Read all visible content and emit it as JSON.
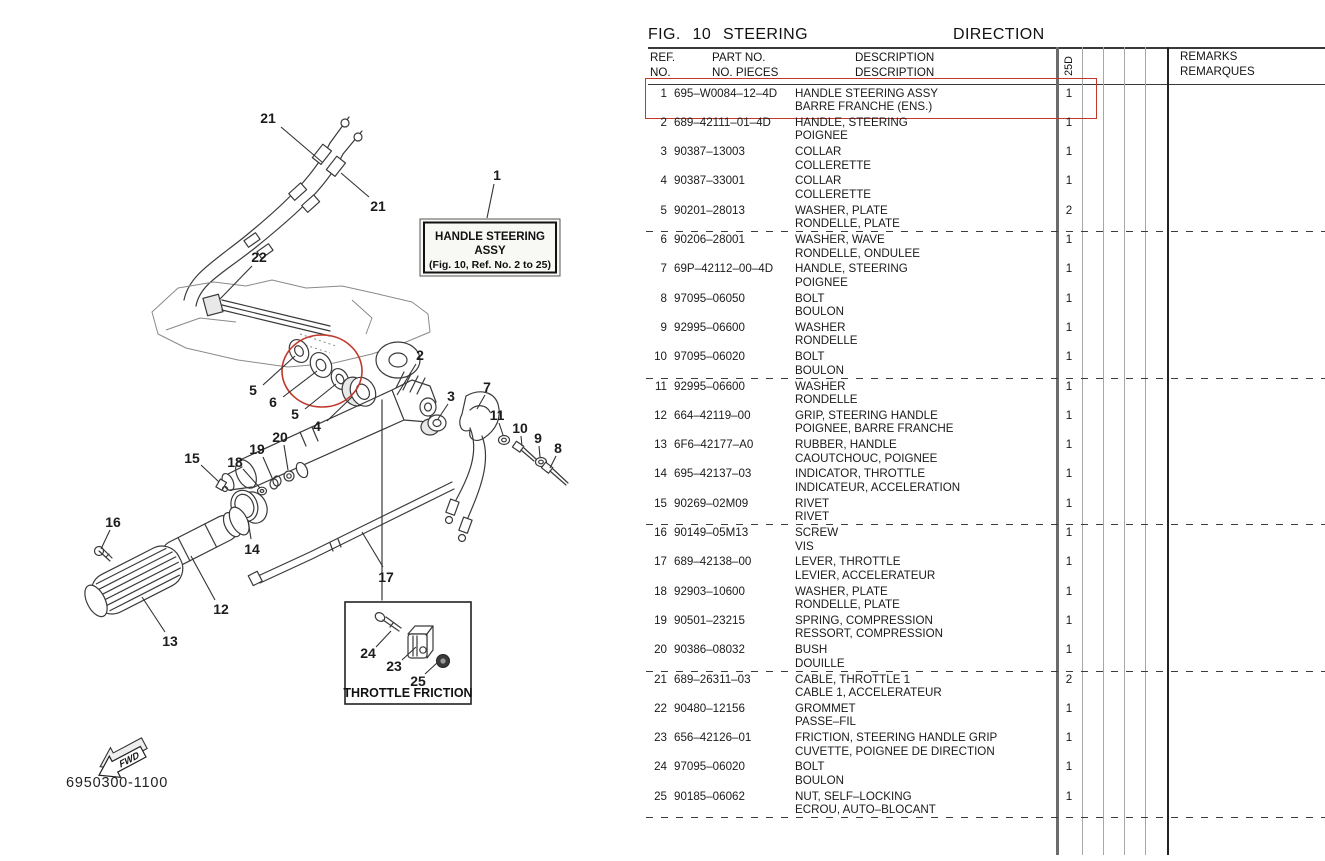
{
  "page": {
    "fig_title": "FIG.  10   STEERING",
    "fig_title_fr": "DIRECTION",
    "doc_number": "6950300-1100"
  },
  "colors": {
    "highlight_red": "#c0392b",
    "line_black": "#3a3a3a"
  },
  "table": {
    "headers": {
      "ref_1": "REF.",
      "ref_2": "NO.",
      "part_1": "PART NO.",
      "part_2": "NO. PIECES",
      "desc_1": "DESCRIPTION",
      "desc_2": "DESCRIPTION",
      "model_col": "25D",
      "remarks_1": "REMARKS",
      "remarks_2": "REMARQUES"
    },
    "group_separator_after_rows": [
      5,
      10,
      15,
      20,
      25
    ],
    "highlighted_ref": "1",
    "rows": [
      {
        "ref": "1",
        "part": "695–W0084–12–4D",
        "desc_en": "HANDLE STEERING ASSY",
        "desc_fr": "BARRE FRANCHE (ENS.)",
        "qty": "1",
        "highlight": true
      },
      {
        "ref": "2",
        "part": "689–42111–01–4D",
        "desc_en": "HANDLE, STEERING",
        "desc_fr": "POIGNEE",
        "qty": "1",
        "highlight": false
      },
      {
        "ref": "3",
        "part": "90387–13003",
        "desc_en": "COLLAR",
        "desc_fr": "COLLERETTE",
        "qty": "1",
        "highlight": false
      },
      {
        "ref": "4",
        "part": "90387–33001",
        "desc_en": "COLLAR",
        "desc_fr": "COLLERETTE",
        "qty": "1",
        "highlight": false
      },
      {
        "ref": "5",
        "part": "90201–28013",
        "desc_en": "WASHER, PLATE",
        "desc_fr": "RONDELLE, PLATE",
        "qty": "2",
        "highlight": false
      },
      {
        "ref": "6",
        "part": "90206–28001",
        "desc_en": "WASHER, WAVE",
        "desc_fr": "RONDELLE, ONDULEE",
        "qty": "1",
        "highlight": false
      },
      {
        "ref": "7",
        "part": "69P–42112–00–4D",
        "desc_en": "HANDLE, STEERING",
        "desc_fr": "POIGNEE",
        "qty": "1",
        "highlight": false
      },
      {
        "ref": "8",
        "part": "97095–06050",
        "desc_en": "BOLT",
        "desc_fr": "BOULON",
        "qty": "1",
        "highlight": false
      },
      {
        "ref": "9",
        "part": "92995–06600",
        "desc_en": "WASHER",
        "desc_fr": "RONDELLE",
        "qty": "1",
        "highlight": false
      },
      {
        "ref": "10",
        "part": "97095–06020",
        "des_en": "",
        "desc_en": "BOLT",
        "desc_fr": "BOULON",
        "qty": "1",
        "highlight": false
      },
      {
        "ref": "11",
        "part": "92995–06600",
        "desc_en": "WASHER",
        "desc_fr": "RONDELLE",
        "qty": "1",
        "highlight": false
      },
      {
        "ref": "12",
        "part": "664–42119–00",
        "desc_en": "GRIP, STEERING HANDLE",
        "desc_fr": "POIGNEE, BARRE FRANCHE",
        "qty": "1",
        "highlight": false
      },
      {
        "ref": "13",
        "part": "6F6–42177–A0",
        "desc_en": "RUBBER, HANDLE",
        "desc_fr": "CAOUTCHOUC, POIGNEE",
        "qty": "1",
        "highlight": false
      },
      {
        "ref": "14",
        "part": "695–42137–03",
        "desc_en": "INDICATOR, THROTTLE",
        "desc_fr": "INDICATEUR, ACCELERATION",
        "qty": "1",
        "highlight": false
      },
      {
        "ref": "15",
        "part": "90269–02M09",
        "desc_en": "RIVET",
        "desc_fr": "RIVET",
        "qty": "1",
        "highlight": false
      },
      {
        "ref": "16",
        "part": "90149–05M13",
        "desc_en": "SCREW",
        "desc_fr": "VIS",
        "qty": "1",
        "highlight": false
      },
      {
        "ref": "17",
        "part": "689–42138–00",
        "desc_en": "LEVER, THROTTLE",
        "desc_fr": "LEVIER, ACCELERATEUR",
        "qty": "1",
        "highlight": false
      },
      {
        "ref": "18",
        "part": "92903–10600",
        "desc_en": "WASHER, PLATE",
        "desc_fr": "RONDELLE, PLATE",
        "qty": "1",
        "highlight": false
      },
      {
        "ref": "19",
        "part": "90501–23215",
        "desc_en": "SPRING, COMPRESSION",
        "desc_fr": "RESSORT, COMPRESSION",
        "qty": "1",
        "highlight": false
      },
      {
        "ref": "20",
        "part": "90386–08032",
        "desc_en": "BUSH",
        "desc_fr": "DOUILLE",
        "qty": "1",
        "highlight": false
      },
      {
        "ref": "21",
        "part": "689–26311–03",
        "desc_en": "CABLE, THROTTLE 1",
        "desc_fr": "CABLE 1, ACCELERATEUR",
        "qty": "2",
        "highlight": false
      },
      {
        "ref": "22",
        "part": "90480–12156",
        "desc_en": "GROMMET",
        "desc_fr": "PASSE–FIL",
        "qty": "1",
        "highlight": false
      },
      {
        "ref": "23",
        "part": "656–42126–01",
        "desc_en": "FRICTION, STEERING HANDLE GRIP",
        "desc_fr": "CUVETTE, POIGNEE DE DIRECTION",
        "qty": "1",
        "highlight": false
      },
      {
        "ref": "24",
        "part": "97095–06020",
        "desc_en": "BOLT",
        "desc_fr": "BOULON",
        "qty": "1",
        "highlight": false
      },
      {
        "ref": "25",
        "part": "90185–06062",
        "desc_en": "NUT, SELF–LOCKING",
        "desc_fr": "ECROU, AUTO–BLOCANT",
        "qty": "1",
        "highlight": false
      }
    ]
  },
  "diagram": {
    "callout_box": {
      "line1": "HANDLE STEERING",
      "line2": "ASSY",
      "line3": "(Fig. 10, Ref. No. 2 to 25)"
    },
    "throttle_friction_label": "THROTTLE FRICTION",
    "fwd_label": "FWD",
    "labels": [
      {
        "t": "21",
        "x": 268,
        "y": 118,
        "lx1": 281,
        "ly1": 127,
        "lx2": 322,
        "ly2": 162
      },
      {
        "t": "21",
        "x": 378,
        "y": 206,
        "lx1": 369,
        "ly1": 197,
        "lx2": 341,
        "ly2": 173
      },
      {
        "t": "22",
        "x": 259,
        "y": 257,
        "lx1": 252,
        "ly1": 266,
        "lx2": 220,
        "ly2": 299
      },
      {
        "t": "1",
        "x": 497,
        "y": 175,
        "lx1": 494,
        "ly1": 184,
        "lx2": 487,
        "ly2": 218
      },
      {
        "t": "5",
        "x": 253,
        "y": 390,
        "lx1": 263,
        "ly1": 385,
        "lx2": 295,
        "ly2": 356
      },
      {
        "t": "6",
        "x": 273,
        "y": 402,
        "lx1": 283,
        "ly1": 397,
        "lx2": 317,
        "ly2": 371
      },
      {
        "t": "5",
        "x": 295,
        "y": 414,
        "lx1": 305,
        "ly1": 409,
        "lx2": 336,
        "ly2": 384
      },
      {
        "t": "4",
        "x": 317,
        "y": 426,
        "lx1": 327,
        "ly1": 421,
        "lx2": 352,
        "ly2": 397
      },
      {
        "t": "2",
        "x": 420,
        "y": 355,
        "lx1": 416,
        "ly1": 364,
        "lx2": 397,
        "ly2": 395
      },
      {
        "t": "3",
        "x": 451,
        "y": 396,
        "lx1": 448,
        "ly1": 404,
        "lx2": 438,
        "ly2": 419
      },
      {
        "t": "7",
        "x": 487,
        "y": 387,
        "lx1": 485,
        "ly1": 395,
        "lx2": 477,
        "ly2": 409
      },
      {
        "t": "11",
        "x": 497,
        "y": 415,
        "lx1": 499,
        "ly1": 423,
        "lx2": 503,
        "ly2": 435
      },
      {
        "t": "10",
        "x": 520,
        "y": 428,
        "lx1": 521,
        "ly1": 436,
        "lx2": 522,
        "ly2": 446
      },
      {
        "t": "9",
        "x": 538,
        "y": 438,
        "lx1": 539,
        "ly1": 446,
        "lx2": 540,
        "ly2": 457
      },
      {
        "t": "8",
        "x": 558,
        "y": 448,
        "lx1": 556,
        "ly1": 456,
        "lx2": 550,
        "ly2": 468
      },
      {
        "t": "15",
        "x": 192,
        "y": 458,
        "lx1": 201,
        "ly1": 465,
        "lx2": 219,
        "ly2": 482
      },
      {
        "t": "18",
        "x": 235,
        "y": 462,
        "lx1": 243,
        "ly1": 469,
        "lx2": 260,
        "ly2": 488
      },
      {
        "t": "19",
        "x": 257,
        "y": 449,
        "lx1": 263,
        "ly1": 457,
        "lx2": 273,
        "ly2": 480
      },
      {
        "t": "20",
        "x": 280,
        "y": 437,
        "lx1": 284,
        "ly1": 445,
        "lx2": 288,
        "ly2": 470
      },
      {
        "t": "16",
        "x": 113,
        "y": 522,
        "lx1": 110,
        "ly1": 530,
        "lx2": 101,
        "ly2": 549
      },
      {
        "t": "14",
        "x": 252,
        "y": 549,
        "lx1": 251,
        "ly1": 539,
        "lx2": 248,
        "ly2": 520
      },
      {
        "t": "12",
        "x": 221,
        "y": 609,
        "lx1": 215,
        "ly1": 600,
        "lx2": 191,
        "ly2": 556
      },
      {
        "t": "13",
        "x": 170,
        "y": 641,
        "lx1": 165,
        "ly1": 632,
        "lx2": 142,
        "ly2": 597
      },
      {
        "t": "17",
        "x": 386,
        "y": 577,
        "lx1": 383,
        "ly1": 567,
        "lx2": 362,
        "ly2": 532
      },
      {
        "t": "24",
        "x": 368,
        "y": 653,
        "lx1": 376,
        "ly1": 647,
        "lx2": 391,
        "ly2": 631
      },
      {
        "t": "23",
        "x": 394,
        "y": 666,
        "lx1": 402,
        "ly1": 660,
        "lx2": 416,
        "ly2": 647
      },
      {
        "t": "25",
        "x": 418,
        "y": 681,
        "lx1": 425,
        "ly1": 674,
        "lx2": 438,
        "ly2": 662
      }
    ]
  }
}
